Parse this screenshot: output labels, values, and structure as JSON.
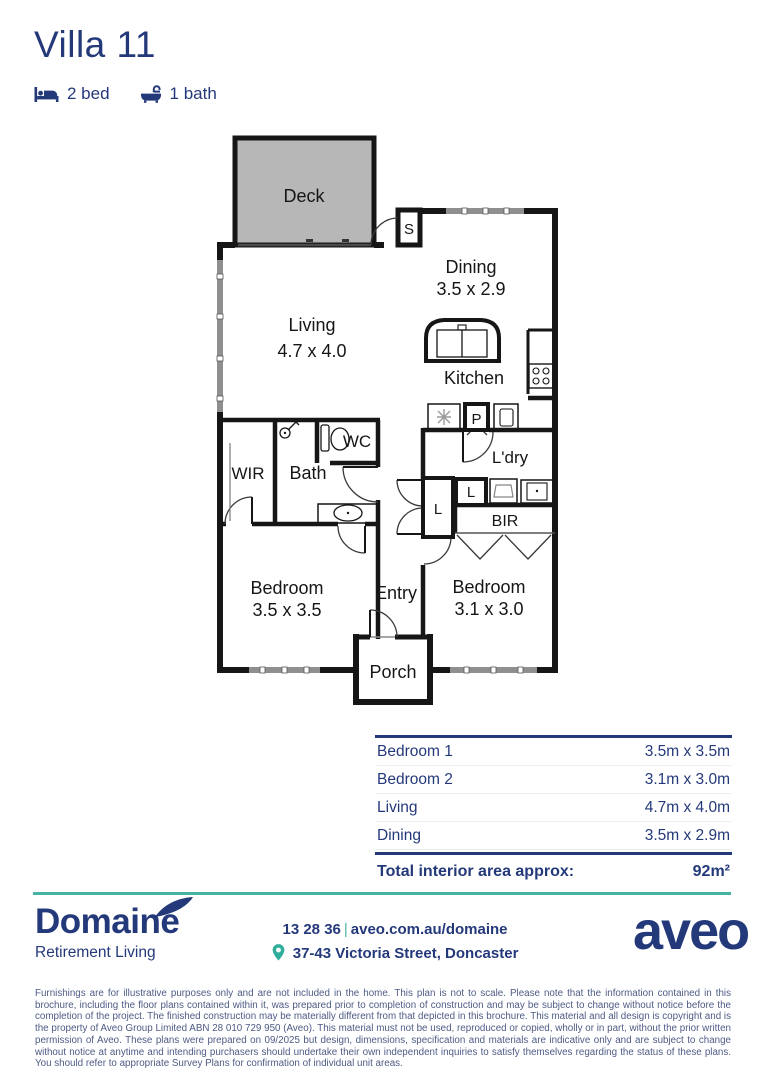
{
  "header": {
    "title": "Villa 11",
    "bed_label": "2 bed",
    "bath_label": "1 bath"
  },
  "floorplan": {
    "deck": "Deck",
    "store": "S",
    "dining": "Dining",
    "dining_dims": "3.5 x 2.9",
    "living": "Living",
    "living_dims": "4.7 x 4.0",
    "kitchen": "Kitchen",
    "pantry": "P",
    "wc": "WC",
    "bath": "Bath",
    "wir": "WIR",
    "laundry": "L'dry",
    "linen_tall": "L",
    "linen_small": "L",
    "bir": "BIR",
    "bedroom1": "Bedroom",
    "bedroom1_dims": "3.5 x 3.5",
    "entry": "Entry",
    "bedroom2": "Bedroom",
    "bedroom2_dims": "3.1 x 3.0",
    "porch": "Porch"
  },
  "dimensions_table": {
    "rows": [
      {
        "label": "Bedroom 1",
        "value": "3.5m x 3.5m"
      },
      {
        "label": "Bedroom 2",
        "value": "3.1m x 3.0m"
      },
      {
        "label": "Living",
        "value": "4.7m x 4.0m"
      },
      {
        "label": "Dining",
        "value": "3.5m x 2.9m"
      }
    ],
    "total_label": "Total interior area approx:",
    "total_value": "92m²"
  },
  "footer": {
    "brand_name": "Domainé",
    "brand_tagline": "Retirement Living",
    "phone": "13 28 36",
    "separator": "|",
    "website": "aveo.com.au/domaine",
    "address": "37-43 Victoria Street, Doncaster",
    "partner_logo": "aveo"
  },
  "disclaimer": "Furnishings are for illustrative purposes only and are not included in the home. This plan is not to scale. Please note that the information contained in this brochure, including the floor plans contained within it, was prepared prior to completion of construction and may be subject to change without notice before the completion of the project. The finished construction may be materially different from that depicted in this brochure. This material and all design is copyright and is the property of Aveo Group Limited ABN 28 010 729 950 (Aveo). This material must not be used, reproduced or copied, wholly or in part, without the prior written permission of Aveo. These plans were prepared on 09/2025 but design, dimensions, specification and materials are indicative only and are subject to change without notice at anytime and intending purchasers should undertake their own independent inquiries to satisfy themselves regarding the status of these plans. You should refer to appropriate Survey Plans for confirmation of individual unit areas.",
  "colors": {
    "navy": "#24397a",
    "teal": "#46b4a4",
    "deck_gray": "#b7b7b7"
  }
}
